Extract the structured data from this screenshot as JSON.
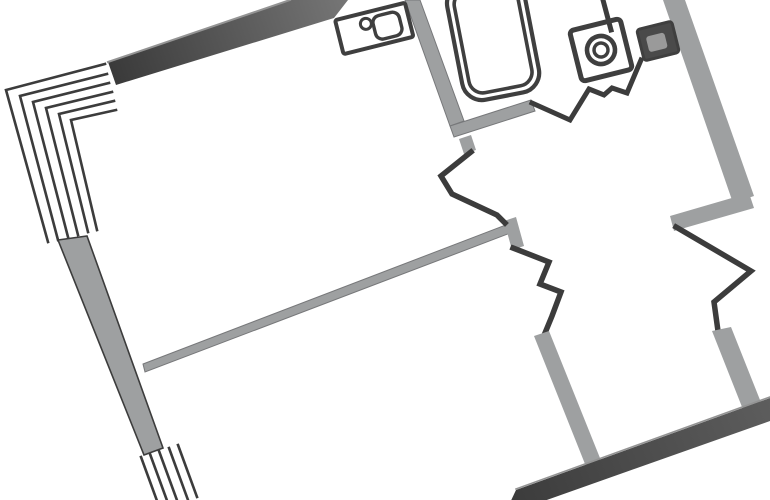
{
  "canvas": {
    "width": 770,
    "height": 500,
    "background": "#ffffff"
  },
  "colors": {
    "light_wall": "#9ea0a1",
    "wall_edge": "#77787a",
    "dark_line": "#3c3c3c",
    "highlight": "#949494",
    "fixture": "#3f3f3f",
    "fixture_fill": "#4a4a4a",
    "fixture_inner": "#9a9a9a"
  },
  "gradients": {
    "gradTop": {
      "x1": 108,
      "y1": 85,
      "x2": 348,
      "y2": 0,
      "from": "#383838",
      "to": "#767676"
    },
    "gradBottom": {
      "x1": 516,
      "y1": 505,
      "x2": 770,
      "y2": 400,
      "from": "#3c3c3c",
      "to": "#5d5d5d"
    }
  },
  "elements": [
    {
      "name": "window-hatch-top-line",
      "type": "polyline",
      "stroke": "dark_line",
      "w": 2.6,
      "pts": [
        [
          105,
          64
        ],
        [
          6,
          90
        ],
        [
          48,
          242
        ]
      ]
    },
    {
      "name": "window-hatch-top-line",
      "type": "polyline",
      "stroke": "dark_line",
      "w": 2.6,
      "pts": [
        [
          107,
          74
        ],
        [
          20,
          96
        ],
        [
          58,
          240
        ]
      ]
    },
    {
      "name": "window-hatch-top-line",
      "type": "polyline",
      "stroke": "dark_line",
      "w": 2.6,
      "pts": [
        [
          109,
          83
        ],
        [
          33,
          102
        ],
        [
          68,
          237
        ]
      ]
    },
    {
      "name": "window-hatch-top-line",
      "type": "polyline",
      "stroke": "dark_line",
      "w": 2.6,
      "pts": [
        [
          112,
          92
        ],
        [
          46,
          108
        ],
        [
          78,
          235
        ]
      ]
    },
    {
      "name": "window-hatch-top-line",
      "type": "polyline",
      "stroke": "dark_line",
      "w": 2.6,
      "pts": [
        [
          114,
          101
        ],
        [
          59,
          114
        ],
        [
          88,
          232
        ]
      ]
    },
    {
      "name": "window-hatch-top-line",
      "type": "polyline",
      "stroke": "dark_line",
      "w": 2.6,
      "pts": [
        [
          116,
          110
        ],
        [
          71,
          120
        ],
        [
          97,
          230
        ]
      ]
    },
    {
      "name": "left-exterior-wall",
      "type": "polygon",
      "fill": "light_wall",
      "stroke": "dark_line",
      "sw": 1.6,
      "pts": [
        [
          58,
          240
        ],
        [
          87,
          236
        ],
        [
          163,
          448
        ],
        [
          144,
          455
        ]
      ]
    },
    {
      "name": "window-hatch-bottom-line",
      "type": "polyline",
      "stroke": "dark_line",
      "w": 2.6,
      "pts": [
        [
          141,
          457
        ],
        [
          160,
          509
        ]
      ]
    },
    {
      "name": "window-hatch-bottom-line",
      "type": "polyline",
      "stroke": "dark_line",
      "w": 2.6,
      "pts": [
        [
          150,
          454
        ],
        [
          169,
          506
        ]
      ]
    },
    {
      "name": "window-hatch-bottom-line",
      "type": "polyline",
      "stroke": "dark_line",
      "w": 2.6,
      "pts": [
        [
          159,
          451
        ],
        [
          178,
          503
        ]
      ]
    },
    {
      "name": "window-hatch-bottom-line",
      "type": "polyline",
      "stroke": "dark_line",
      "w": 2.6,
      "pts": [
        [
          169,
          448
        ],
        [
          188,
          500
        ]
      ]
    },
    {
      "name": "window-hatch-bottom-line",
      "type": "polyline",
      "stroke": "dark_line",
      "w": 2.6,
      "pts": [
        [
          178,
          445
        ],
        [
          197,
          497
        ]
      ]
    },
    {
      "name": "top-exterior-wall",
      "type": "polygon",
      "fill": "gradTop",
      "pts": [
        [
          108,
          62
        ],
        [
          290,
          0
        ],
        [
          348,
          0
        ],
        [
          334,
          18
        ],
        [
          116,
          85
        ]
      ]
    },
    {
      "name": "top-wall-highlight",
      "type": "polyline",
      "stroke": "highlight",
      "w": 2,
      "pts": [
        [
          108,
          62
        ],
        [
          290,
          0
        ]
      ]
    },
    {
      "name": "living-partition-wall",
      "type": "polygon",
      "fill": "light_wall",
      "stroke": "wall_edge",
      "sw": 1,
      "pts": [
        [
          143,
          364
        ],
        [
          511,
          223
        ],
        [
          513,
          232
        ],
        [
          145,
          372
        ]
      ]
    },
    {
      "name": "hall-junction-stub",
      "type": "polygon",
      "fill": "light_wall",
      "pts": [
        [
          504,
          221
        ],
        [
          516,
          217
        ],
        [
          524,
          246
        ],
        [
          512,
          250
        ]
      ]
    },
    {
      "name": "kitchen-partition-wall",
      "type": "polygon",
      "fill": "light_wall",
      "stroke": "wall_edge",
      "sw": 1,
      "pts": [
        [
          405,
          0
        ],
        [
          420,
          0
        ],
        [
          464,
          121
        ],
        [
          450,
          126
        ]
      ]
    },
    {
      "name": "bath-partition-wall",
      "type": "polygon",
      "fill": "light_wall",
      "stroke": "wall_edge",
      "sw": 1,
      "pts": [
        [
          450,
          126
        ],
        [
          531,
          100
        ],
        [
          535,
          111
        ],
        [
          454,
          137
        ]
      ]
    },
    {
      "name": "door-jamb-stub",
      "type": "polygon",
      "fill": "light_wall",
      "pts": [
        [
          459,
          139
        ],
        [
          471,
          135
        ],
        [
          476,
          150
        ],
        [
          464,
          154
        ]
      ]
    },
    {
      "name": "alcove-wall",
      "type": "polyline",
      "stroke": "dark_line",
      "w": 5.5,
      "pts": [
        [
          471,
          152
        ],
        [
          441,
          176
        ],
        [
          452,
          194
        ],
        [
          497,
          215
        ],
        [
          505,
          223
        ]
      ]
    },
    {
      "name": "closet-wall",
      "type": "polyline",
      "stroke": "dark_line",
      "w": 5.5,
      "pts": [
        [
          513,
          248
        ],
        [
          549,
          262
        ],
        [
          540,
          284
        ],
        [
          561,
          292
        ],
        [
          552,
          316
        ],
        [
          545,
          333
        ]
      ]
    },
    {
      "name": "bedroom-partition-wall",
      "type": "polygon",
      "fill": "light_wall",
      "pts": [
        [
          534,
          336
        ],
        [
          549,
          331
        ],
        [
          604,
          468
        ],
        [
          589,
          474
        ]
      ]
    },
    {
      "name": "right-exterior-wall-upper",
      "type": "polygon",
      "fill": "light_wall",
      "pts": [
        [
          663,
          0
        ],
        [
          685,
          0
        ],
        [
          754,
          196
        ],
        [
          733,
          203
        ]
      ]
    },
    {
      "name": "right-wall-jut",
      "type": "polygon",
      "fill": "light_wall",
      "pts": [
        [
          749,
          193
        ],
        [
          670,
          216
        ],
        [
          674,
          231
        ],
        [
          754,
          208
        ]
      ]
    },
    {
      "name": "right-niche-wall",
      "type": "polyline",
      "stroke": "dark_line",
      "w": 5.5,
      "pts": [
        [
          676,
          227
        ],
        [
          751,
          271
        ],
        [
          714,
          302
        ],
        [
          718,
          331
        ]
      ]
    },
    {
      "name": "right-exterior-wall-lower",
      "type": "polygon",
      "fill": "light_wall",
      "pts": [
        [
          712,
          331
        ],
        [
          731,
          327
        ],
        [
          762,
          405
        ],
        [
          744,
          412
        ]
      ]
    },
    {
      "name": "bottom-exterior-wall",
      "type": "polygon",
      "fill": "gradBottom",
      "pts": [
        [
          516,
          490
        ],
        [
          770,
          398
        ],
        [
          770,
          421
        ],
        [
          527,
          507
        ],
        [
          508,
          507
        ]
      ]
    },
    {
      "name": "bottom-wall-highlight",
      "type": "polyline",
      "stroke": "highlight",
      "w": 1.6,
      "pts": [
        [
          516,
          489
        ],
        [
          770,
          397
        ]
      ]
    },
    {
      "name": "bathroom-wall",
      "type": "polyline",
      "stroke": "dark_line",
      "w": 5,
      "pts": [
        [
          532,
          103
        ],
        [
          570,
          120
        ],
        [
          589,
          89
        ],
        [
          604,
          95
        ],
        [
          612,
          88
        ],
        [
          627,
          93
        ],
        [
          641,
          60
        ]
      ]
    },
    {
      "name": "entry-wall-stub",
      "type": "polyline",
      "stroke": "dark_line",
      "w": 5,
      "pts": [
        [
          603,
          0
        ],
        [
          611,
          30
        ]
      ]
    },
    {
      "name": "bathtub",
      "type": "group",
      "rotate": [
        -11,
        495,
        48
      ],
      "shapes": [
        {
          "kind": "rect",
          "x": 456,
          "y": -21,
          "w": 78,
          "h": 118,
          "rx": 20,
          "stroke": "fixture",
          "sw": 4.2
        },
        {
          "kind": "rect",
          "x": 463,
          "y": -14,
          "w": 64,
          "h": 104,
          "rx": 14,
          "stroke": "fixture",
          "sw": 3.6
        }
      ]
    },
    {
      "name": "kitchen-sink",
      "type": "group",
      "rotate": [
        -14,
        378,
        27
      ],
      "shapes": [
        {
          "kind": "rect",
          "x": 338,
          "y": 10,
          "w": 72,
          "h": 35,
          "rx": 2,
          "stroke": "fixture",
          "sw": 4
        },
        {
          "kind": "rect",
          "x": 374,
          "y": 16,
          "w": 27,
          "h": 24,
          "rx": 7,
          "stroke": "fixture",
          "sw": 3.4
        },
        {
          "kind": "circle",
          "cx": 367,
          "cy": 21,
          "r": 5.5,
          "stroke": "fixture",
          "sw": 3
        }
      ]
    },
    {
      "name": "washing-machine",
      "type": "group",
      "rotate": [
        -14,
        601,
        50
      ],
      "shapes": [
        {
          "kind": "rect",
          "x": 575,
          "y": 24,
          "w": 52,
          "h": 52,
          "rx": 4,
          "stroke": "fixture",
          "sw": 5
        },
        {
          "kind": "circle",
          "cx": 601,
          "cy": 50,
          "r": 14,
          "stroke": "fixture",
          "sw": 4.6
        },
        {
          "kind": "circle",
          "cx": 601,
          "cy": 50,
          "r": 7,
          "stroke": "fixture",
          "sw": 3.4
        }
      ]
    },
    {
      "name": "bathroom-sink",
      "type": "group",
      "rotate": [
        -14,
        658,
        41
      ],
      "shapes": [
        {
          "kind": "rect",
          "x": 640,
          "y": 25,
          "w": 36,
          "h": 32,
          "rx": 3,
          "fill": "fixture_fill",
          "stroke": "fixture",
          "sw": 3
        },
        {
          "kind": "rect",
          "x": 647,
          "y": 34,
          "w": 19,
          "h": 16,
          "rx": 3,
          "fill": "fixture_inner"
        }
      ]
    }
  ]
}
